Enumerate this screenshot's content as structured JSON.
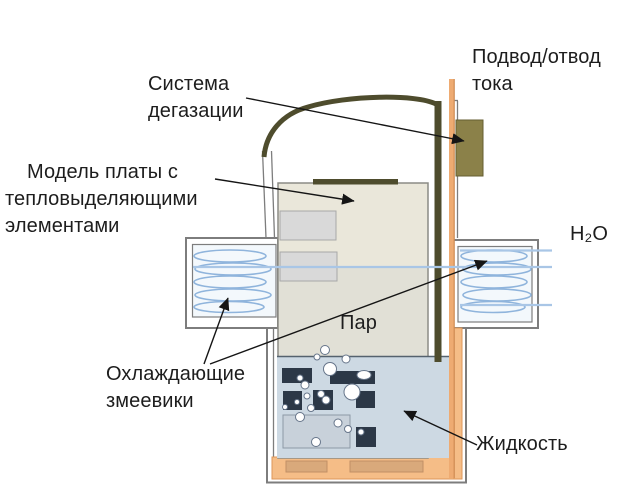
{
  "labels": {
    "degassing": {
      "line1": "Система",
      "line2": "дегазации"
    },
    "board_model": {
      "line1": "Модель платы с",
      "line2": "тепловыделяющими",
      "line3": "элементами"
    },
    "current": {
      "line1": "Подвод/отвод",
      "line2": "тока"
    },
    "water": "H₂O",
    "vapor": "Пар",
    "coils": {
      "line1": "Охлаждающие",
      "line2": "змеевики"
    },
    "liquid": "Жидкость"
  },
  "colors": {
    "text": "#1d1d1d",
    "wall": "#7d7d7d",
    "coil": "#8fb4dc",
    "pipe": "#a9c6e6",
    "board": "#eae7da",
    "olive": "#4e4c2d",
    "wire": "#eeab72",
    "wire_edge": "#cf8a52",
    "block": "#8b8149",
    "liquid": "#cdd9e3",
    "chip": "#2c3847",
    "lining": "#f5bd87",
    "foot": "#d9a97b",
    "arm_fill": "#f3f8fc"
  }
}
